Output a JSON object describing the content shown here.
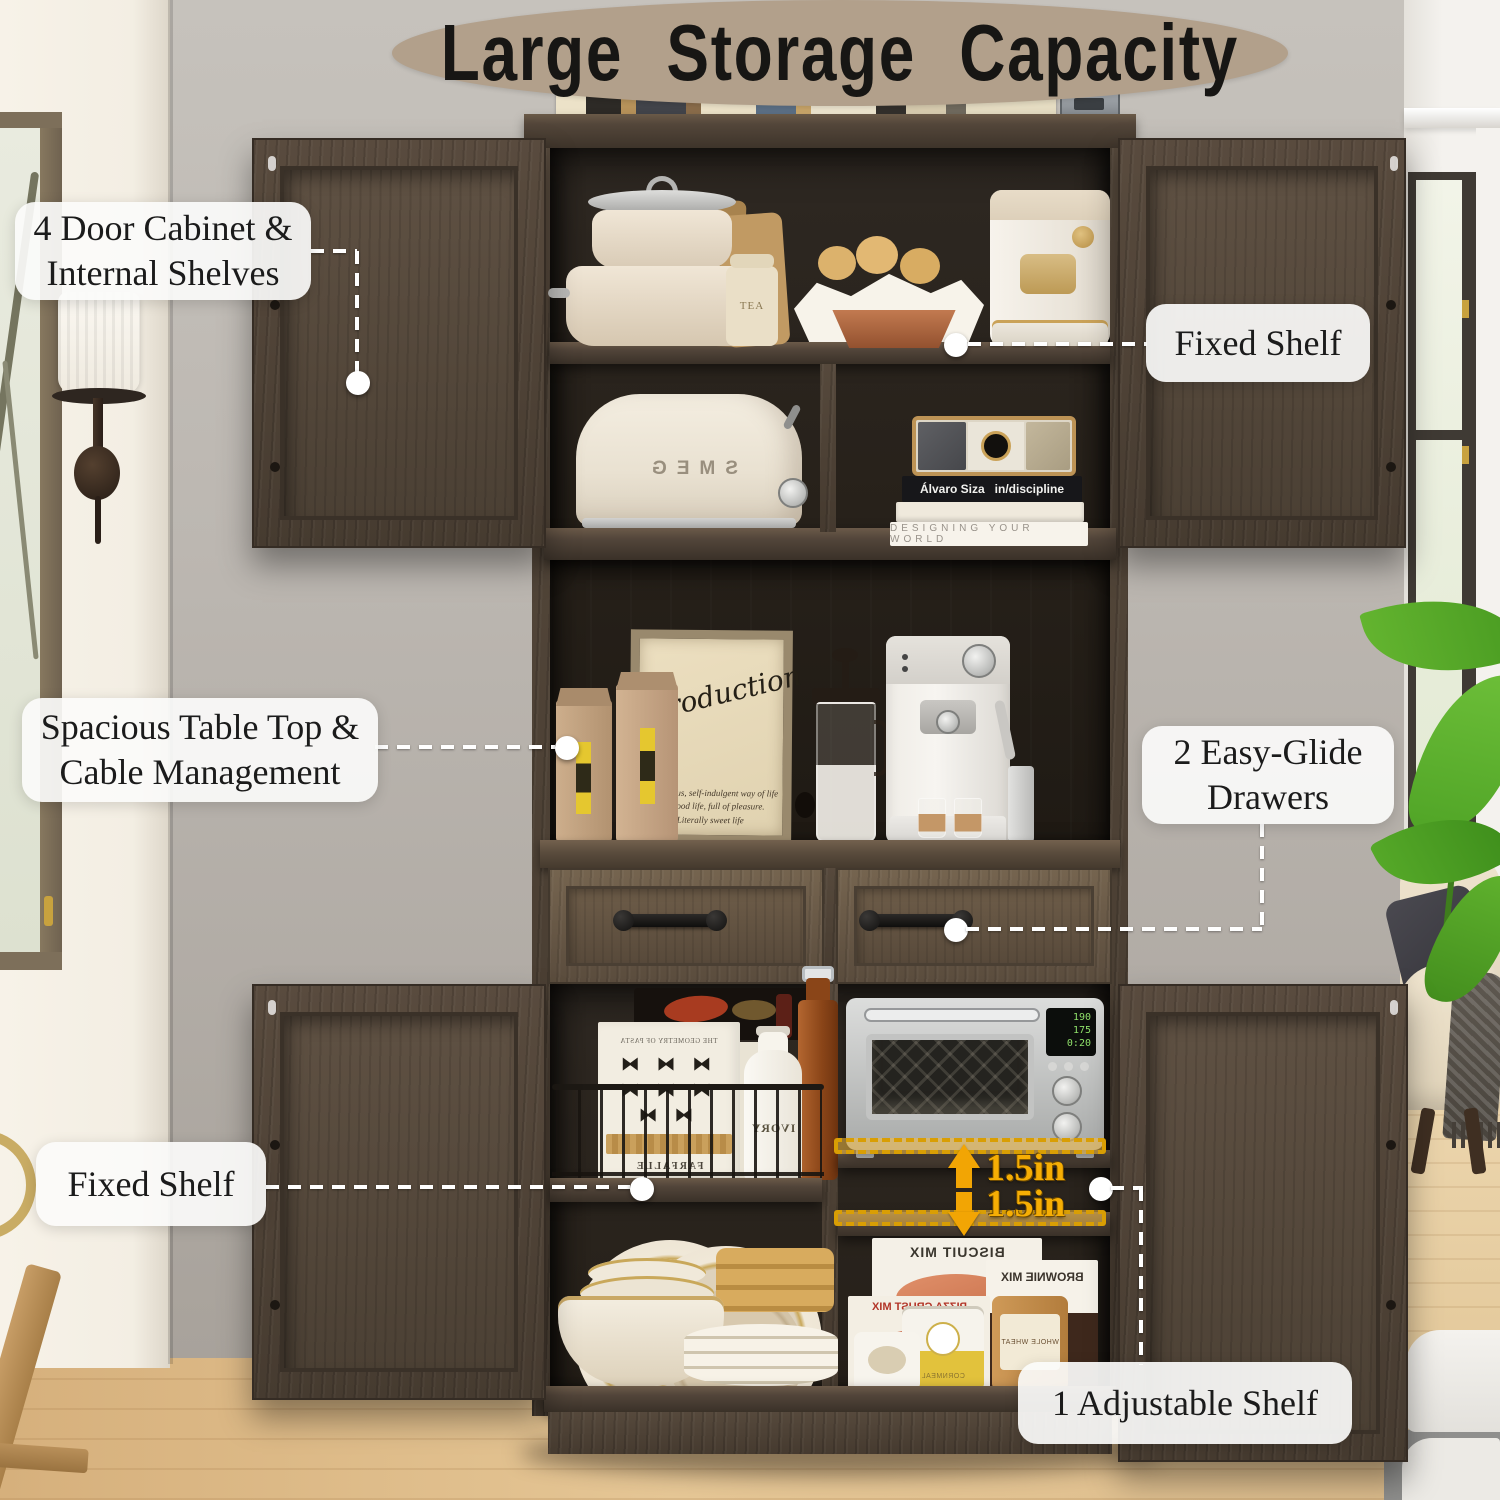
{
  "title": {
    "text": "Large Storage Capacity"
  },
  "callouts": [
    {
      "id": "four-door-cabinet",
      "lines": [
        "4 Door Cabinet &",
        "Internal Shelves"
      ]
    },
    {
      "id": "fixed-shelf-top",
      "lines": [
        "Fixed Shelf"
      ]
    },
    {
      "id": "spacious-table-top",
      "lines": [
        "Spacious Table Top &",
        "Cable Management"
      ]
    },
    {
      "id": "easy-glide-drawers",
      "lines": [
        "2 Easy-Glide",
        "Drawers"
      ]
    },
    {
      "id": "fixed-shelf-bottom",
      "lines": [
        "Fixed Shelf"
      ]
    },
    {
      "id": "adjustable-shelf",
      "lines": [
        "1 Adjustable Shelf"
      ]
    }
  ],
  "measurements": {
    "gap_up": "1.5in",
    "gap_down": "1.5in"
  },
  "scene": {
    "tea_canister": "TEA",
    "toaster_brand": "SMEG",
    "book_author": "Álvaro Siza",
    "book_title": "in/discipline",
    "book_bottom": "DESIGNING YOUR WORLD",
    "sign_title": "Introduction",
    "sign_line1": "A luxurious, self-indulgent way of life",
    "sign_line2": "The good life, full of pleasure.",
    "sign_line3": "Literally sweet life",
    "pasta_box_title": "THE GEOMETRY OF PASTA",
    "pasta_box_label": "FARFALLE",
    "pasta_glyphs": "⧓ ⧓ ⧓ ⧓ ⧓ ⧓ ⧓ ⧓",
    "bottle_label": "IVORY",
    "box_biscuit": "BISCUIT MIX",
    "box_pizza": "PIZZA CRUST MIX",
    "box_brownie": "BROWNIE MIX",
    "can_cornmeal": "CORNMEAL",
    "can_wheat": "WHOLE WHEAT",
    "oven_display": [
      "190",
      "175",
      "0:20"
    ]
  },
  "colors": {
    "banner_bg": "#b2a08b",
    "title_text": "#171614",
    "label_bg": "#fbfbfa",
    "connector": "#ffffff",
    "measure_text": "#f6ae04",
    "highlight_fill": "#f6bd46",
    "highlight_border": "#d99e04",
    "cabinet_wood": "#54473a",
    "cabinet_interior": "#262019",
    "drawer_front": "#6e5d49",
    "wall": "#bcb7b1",
    "left_wall": "#f3eee3",
    "floor": "#dcbc8c",
    "plant_green": "#5fb12d"
  }
}
